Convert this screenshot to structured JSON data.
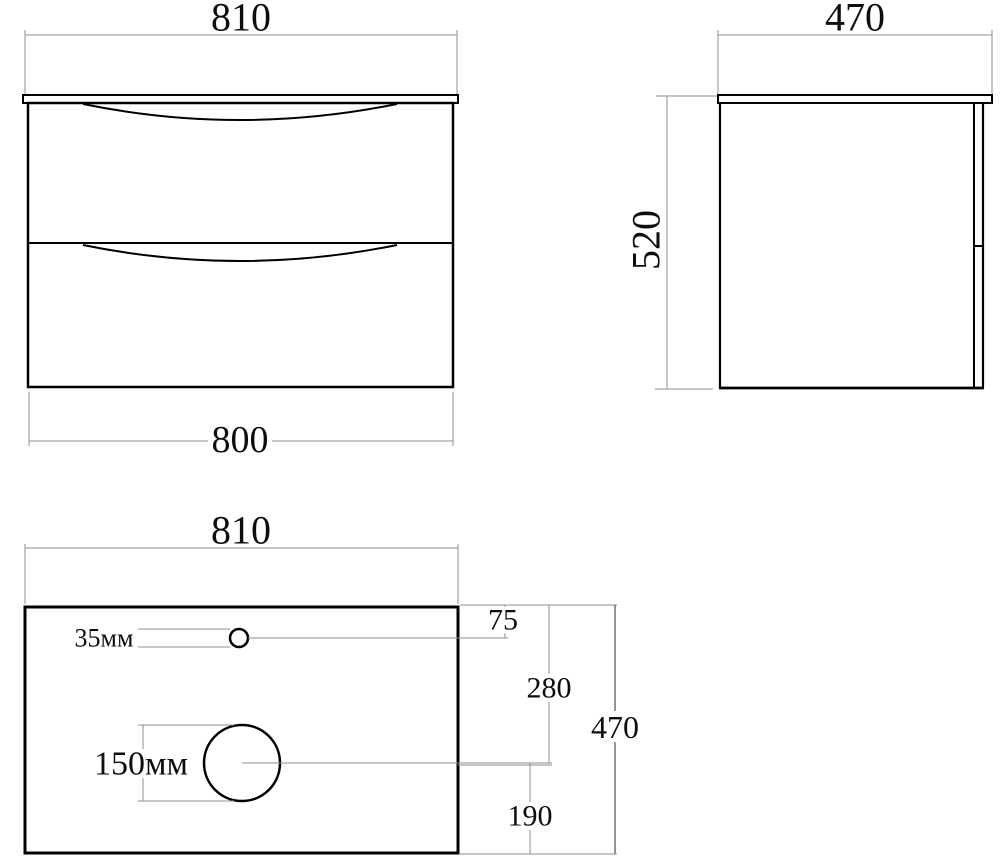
{
  "colors": {
    "object_line": "#000000",
    "dimension_line": "#8f8f8f",
    "dark_dimension_line": "#2a2a2a",
    "background": "#ffffff"
  },
  "front_view": {
    "top_width": "810",
    "bottom_width": "800"
  },
  "side_view": {
    "top_depth": "470",
    "height": "520"
  },
  "plan_view": {
    "top_width": "810",
    "faucet_hole": "35мм",
    "drain_hole": "150мм",
    "faucet_offset": "75",
    "drain_offset_back": "280",
    "depth": "470",
    "drain_offset_front": "190"
  }
}
